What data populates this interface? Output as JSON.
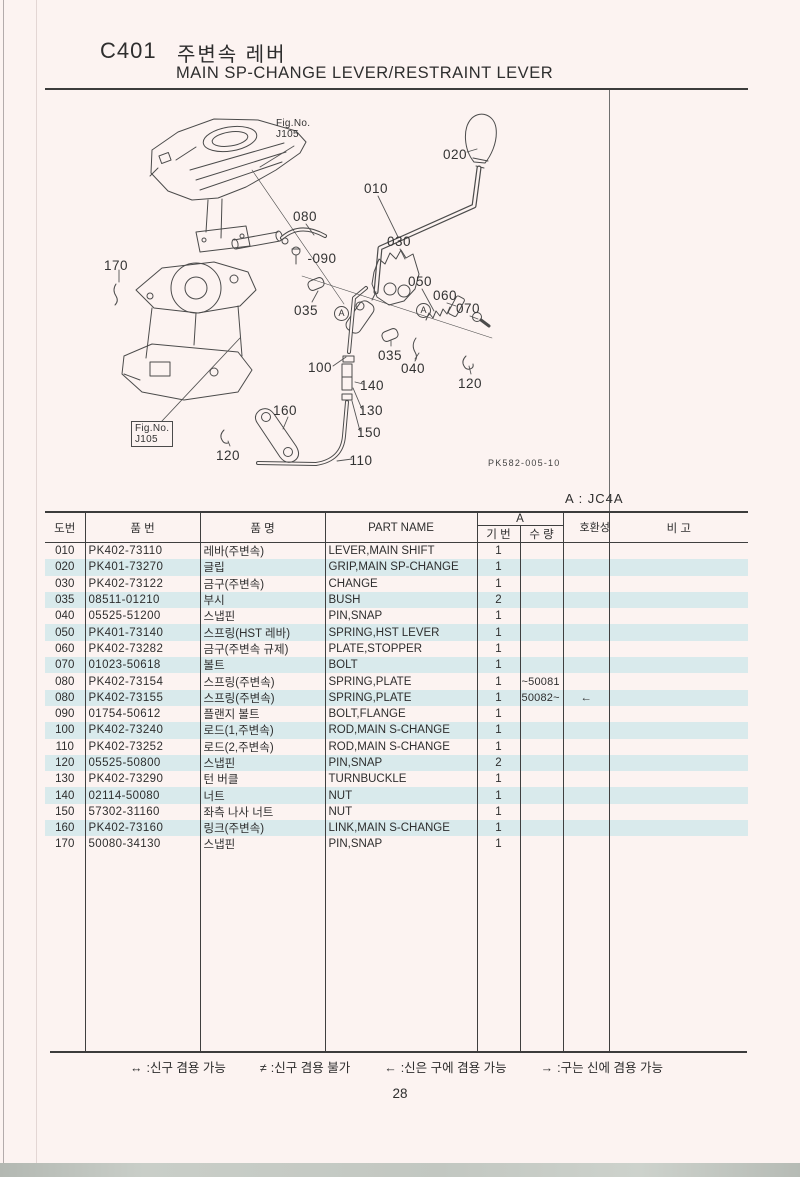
{
  "page": {
    "code": "C401",
    "title_ko": "주변속 레버",
    "title_en": "MAIN SP-CHANGE LEVER/RESTRAINT LEVER",
    "model_note": "A : JC4A",
    "page_number": "28"
  },
  "diagram": {
    "fig_ref_top": {
      "line1": "Fig.No.",
      "line2": "J105"
    },
    "fig_ref_bottom": {
      "line1": "Fig.No.",
      "line2": "J105"
    },
    "drawing_code": "PK582-005-10",
    "detail_marker": "A",
    "callouts": [
      {
        "label": "020",
        "x": 455,
        "y": 147
      },
      {
        "label": "010",
        "x": 376,
        "y": 181
      },
      {
        "label": "080",
        "x": 305,
        "y": 209
      },
      {
        "label": "030",
        "x": 399,
        "y": 234
      },
      {
        "label": "-090",
        "x": 322,
        "y": 251
      },
      {
        "label": "050",
        "x": 420,
        "y": 274
      },
      {
        "label": "060",
        "x": 445,
        "y": 288
      },
      {
        "label": "070",
        "x": 468,
        "y": 301
      },
      {
        "label": "035",
        "x": 306,
        "y": 303
      },
      {
        "label": "035",
        "x": 390,
        "y": 348
      },
      {
        "label": "040",
        "x": 413,
        "y": 361
      },
      {
        "label": "100",
        "x": 320,
        "y": 360
      },
      {
        "label": "140",
        "x": 372,
        "y": 378
      },
      {
        "label": "130",
        "x": 371,
        "y": 403
      },
      {
        "label": "150",
        "x": 369,
        "y": 425
      },
      {
        "label": "160",
        "x": 285,
        "y": 403
      },
      {
        "label": "110",
        "x": 361,
        "y": 453
      },
      {
        "label": "120",
        "x": 470,
        "y": 376
      },
      {
        "label": "120",
        "x": 228,
        "y": 448
      },
      {
        "label": "170",
        "x": 116,
        "y": 258
      }
    ]
  },
  "table": {
    "headers": {
      "col_no": "도번",
      "col_part_no": "품  번",
      "col_name_ko": "품    명",
      "col_part_name": "PART NAME",
      "group_a": "A",
      "sub_serial": "기 번",
      "sub_qty": "수 량",
      "col_compat": "호환성",
      "col_remarks": "비  고"
    },
    "rows": [
      {
        "no": "010",
        "part_no": "PK402-73110",
        "name_ko": "레바(주변속)",
        "part_name": "LEVER,MAIN SHIFT",
        "qty": "1",
        "serial": "",
        "compat": ""
      },
      {
        "no": "020",
        "part_no": "PK401-73270",
        "name_ko": "글립",
        "part_name": "GRIP,MAIN SP-CHANGE",
        "qty": "1",
        "serial": "",
        "compat": ""
      },
      {
        "no": "030",
        "part_no": "PK402-73122",
        "name_ko": "금구(주변속)",
        "part_name": "CHANGE",
        "qty": "1",
        "serial": "",
        "compat": ""
      },
      {
        "no": "035",
        "part_no": "08511-01210",
        "name_ko": "부시",
        "part_name": "BUSH",
        "qty": "2",
        "serial": "",
        "compat": ""
      },
      {
        "no": "040",
        "part_no": "05525-51200",
        "name_ko": "스냅핀",
        "part_name": "PIN,SNAP",
        "qty": "1",
        "serial": "",
        "compat": ""
      },
      {
        "no": "050",
        "part_no": "PK401-73140",
        "name_ko": "스프링(HST 레바)",
        "part_name": "SPRING,HST LEVER",
        "qty": "1",
        "serial": "",
        "compat": ""
      },
      {
        "no": "060",
        "part_no": "PK402-73282",
        "name_ko": "금구(주변속 규제)",
        "part_name": "PLATE,STOPPER",
        "qty": "1",
        "serial": "",
        "compat": ""
      },
      {
        "no": "070",
        "part_no": "01023-50618",
        "name_ko": "볼트",
        "part_name": "BOLT",
        "qty": "1",
        "serial": "",
        "compat": ""
      },
      {
        "no": "080",
        "part_no": "PK402-73154",
        "name_ko": "스프링(주변속)",
        "part_name": "SPRING,PLATE",
        "qty": "1",
        "serial": "~50081",
        "compat": ""
      },
      {
        "no": "080",
        "part_no": "PK402-73155",
        "name_ko": "스프링(주변속)",
        "part_name": "SPRING,PLATE",
        "qty": "1",
        "serial": "50082~",
        "compat": "←"
      },
      {
        "no": "090",
        "part_no": "01754-50612",
        "name_ko": "플랜지 볼트",
        "part_name": "BOLT,FLANGE",
        "qty": "1",
        "serial": "",
        "compat": ""
      },
      {
        "no": "100",
        "part_no": "PK402-73240",
        "name_ko": "로드(1,주변속)",
        "part_name": "ROD,MAIN S-CHANGE",
        "qty": "1",
        "serial": "",
        "compat": ""
      },
      {
        "no": "110",
        "part_no": "PK402-73252",
        "name_ko": "로드(2,주변속)",
        "part_name": "ROD,MAIN S-CHANGE",
        "qty": "1",
        "serial": "",
        "compat": ""
      },
      {
        "no": "120",
        "part_no": "05525-50800",
        "name_ko": "스냅핀",
        "part_name": "PIN,SNAP",
        "qty": "2",
        "serial": "",
        "compat": ""
      },
      {
        "no": "130",
        "part_no": "PK402-73290",
        "name_ko": "턴 버클",
        "part_name": "TURNBUCKLE",
        "qty": "1",
        "serial": "",
        "compat": ""
      },
      {
        "no": "140",
        "part_no": "02114-50080",
        "name_ko": "너트",
        "part_name": "NUT",
        "qty": "1",
        "serial": "",
        "compat": ""
      },
      {
        "no": "150",
        "part_no": "57302-31160",
        "name_ko": "좌측 나사 너트",
        "part_name": "NUT",
        "qty": "1",
        "serial": "",
        "compat": ""
      },
      {
        "no": "160",
        "part_no": "PK402-73160",
        "name_ko": "링크(주변속)",
        "part_name": "LINK,MAIN S-CHANGE",
        "qty": "1",
        "serial": "",
        "compat": ""
      },
      {
        "no": "170",
        "part_no": "50080-34130",
        "name_ko": "스냅핀",
        "part_name": "PIN,SNAP",
        "qty": "1",
        "serial": "",
        "compat": ""
      }
    ]
  },
  "footer": {
    "legend": [
      {
        "symbol": "↔",
        "text": ":신구 겸용 가능"
      },
      {
        "symbol": "≠",
        "text": ":신구 겸용 불가"
      },
      {
        "symbol": "←",
        "text": ":신은 구에 겸용 가능"
      },
      {
        "symbol": "→",
        "text": ":구는 신에 겸용 가능"
      }
    ]
  }
}
